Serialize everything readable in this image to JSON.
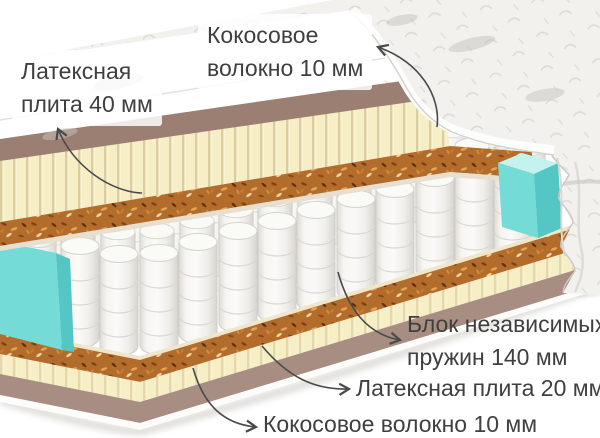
{
  "diagram": {
    "type": "mattress-cross-section",
    "labels": {
      "latex_top": {
        "line1": "Латексная",
        "line2": "плита 40 мм"
      },
      "coir_top": {
        "line1": "Кокосовое",
        "line2": "волокно 10 мм"
      },
      "springs": {
        "line1": "Блок независимых",
        "line2": "пружин 140 мм"
      },
      "latex_bottom": {
        "text": "Латексная плита 20 мм"
      },
      "coir_bottom": {
        "text": "Кокосовое волокно 10 мм"
      }
    },
    "colors": {
      "cover": "#f2f1ee",
      "trim_top": "#9c7f73",
      "latex": "#f6eec5",
      "latex_top_face": "#f3ecca",
      "coir": "#b26c2c",
      "felt": "#efe6cc",
      "spring": "#f4f3f0",
      "side_support": "#74dbd7",
      "side_support_side": "#54c6c4",
      "side_support_top": "#c4f2ee",
      "trim_bottom": "#a78d82",
      "text": "#3f3f3f",
      "arrow": "#4a4a4a"
    }
  }
}
